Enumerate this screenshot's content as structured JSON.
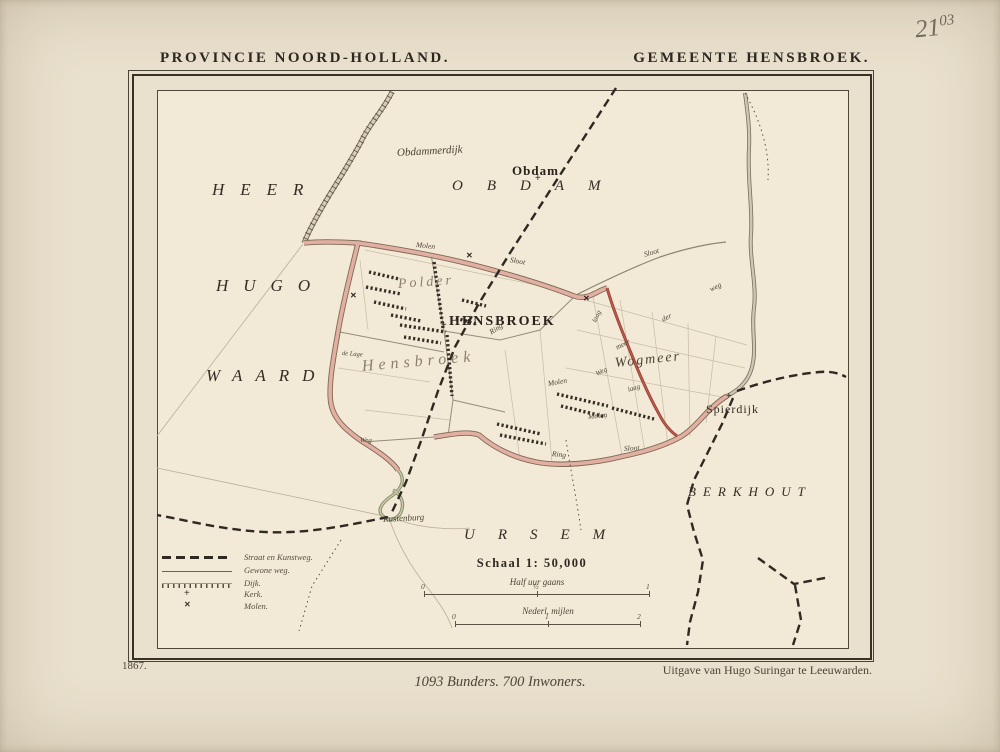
{
  "annotation": {
    "main": "21",
    "sup": "03"
  },
  "header": {
    "left": "PROVINCIE NOORD-HOLLAND.",
    "right": "GEMEENTE HENSBROEK."
  },
  "footer": {
    "year": "1867.",
    "publisher": "Uitgave van Hugo Suringar te Leeuwarden.",
    "stats": "1093 Bunders. 700 Inwoners."
  },
  "scale": {
    "schaal": "Schaal 1: 50,000",
    "bar1": {
      "label": "Half uur gaans",
      "ticks": [
        "0",
        "½",
        "1"
      ]
    },
    "bar2": {
      "label": "Nederl. mijlen",
      "ticks": [
        "0",
        "1",
        "2"
      ]
    }
  },
  "legend": {
    "items": [
      {
        "label": "Straat en Kunstweg.",
        "symbol": "road-dashed"
      },
      {
        "label": "Gewone weg.",
        "symbol": "line-thin"
      },
      {
        "label": "Dijk.",
        "symbol": "line-hatched"
      },
      {
        "label": "Kerk.",
        "symbol": "cross"
      },
      {
        "label": "Molen.",
        "symbol": "windmill"
      }
    ]
  },
  "icons": {
    "kerk": "+",
    "molen": "✕"
  },
  "colors": {
    "paper": "#e9e0cd",
    "map_paper": "#f2e9d6",
    "ink": "#2c2721",
    "road_pink": "#e2afa2",
    "road_red": "#c2564a",
    "road_gray": "#d6ccb8",
    "faded_label": "#8a7f6a"
  },
  "map": {
    "labels": [
      {
        "name": "label-obdammerdijk",
        "text": "Obdammerdijk",
        "x": 397,
        "y": 147,
        "fs": 11,
        "rot": -3,
        "cls": "script"
      },
      {
        "name": "label-obdam-town",
        "text": "Obdam",
        "x": 512,
        "y": 163,
        "fs": 13,
        "cls": "town"
      },
      {
        "name": "label-obdam-region",
        "text": "OBDAM",
        "x": 452,
        "y": 178,
        "fs": 15,
        "ls": 24,
        "cls": "region"
      },
      {
        "name": "label-heer",
        "text": "HEER",
        "x": 212,
        "y": 180,
        "fs": 17,
        "ls": 16,
        "cls": "region"
      },
      {
        "name": "label-hugo",
        "text": "HUGO",
        "x": 216,
        "y": 276,
        "fs": 17,
        "ls": 15,
        "cls": "region"
      },
      {
        "name": "label-waard",
        "text": "WAARD",
        "x": 206,
        "y": 366,
        "fs": 17,
        "ls": 13,
        "cls": "region"
      },
      {
        "name": "label-polder",
        "text": "Polder",
        "x": 398,
        "y": 277,
        "fs": 14,
        "ls": 3,
        "rot": -4,
        "cls": "scriptfaded"
      },
      {
        "name": "label-hensbroek-town",
        "text": "HENSBROEK",
        "x": 449,
        "y": 314,
        "fs": 14,
        "ls": 2,
        "cls": "town"
      },
      {
        "name": "label-hensbroek-polder",
        "text": "Hensbroek",
        "x": 362,
        "y": 358,
        "fs": 16,
        "ls": 5,
        "rot": -5,
        "cls": "scriptfaded"
      },
      {
        "name": "label-wogmeer",
        "text": "Wogmeer",
        "x": 615,
        "y": 356,
        "fs": 14,
        "ls": 2,
        "rot": -6,
        "cls": "script"
      },
      {
        "name": "label-spierdijk",
        "text": "Spierdijk",
        "x": 706,
        "y": 402,
        "fs": 12,
        "cls": "townlight"
      },
      {
        "name": "label-berkhout",
        "text": "BERKHOUT",
        "x": 688,
        "y": 484,
        "fs": 13,
        "ls": 7,
        "cls": "region"
      },
      {
        "name": "label-ursem",
        "text": "URSEM",
        "x": 464,
        "y": 527,
        "fs": 15,
        "ls": 23,
        "cls": "region"
      },
      {
        "name": "label-rustenburg",
        "text": "Rustenburg",
        "x": 383,
        "y": 514,
        "fs": 9,
        "rot": -3,
        "cls": "script"
      },
      {
        "name": "road-label-molen-1",
        "text": "Molen",
        "x": 416,
        "y": 240,
        "fs": 7.5,
        "rot": 6,
        "cls": "road"
      },
      {
        "name": "road-label-sloot-1",
        "text": "Sloot",
        "x": 510,
        "y": 255,
        "fs": 7.5,
        "rot": 10,
        "cls": "road"
      },
      {
        "name": "road-label-sloot-2",
        "text": "Sloot",
        "x": 644,
        "y": 250,
        "fs": 7.5,
        "rot": -16,
        "cls": "road"
      },
      {
        "name": "road-label-weg-1",
        "text": "weg",
        "x": 710,
        "y": 285,
        "fs": 7.5,
        "rot": -27,
        "cls": "road"
      },
      {
        "name": "road-label-der",
        "text": "der",
        "x": 662,
        "y": 315,
        "fs": 7.5,
        "rot": -27,
        "cls": "road"
      },
      {
        "name": "road-label-meer",
        "text": "meer",
        "x": 616,
        "y": 343,
        "fs": 7.5,
        "rot": -27,
        "cls": "road"
      },
      {
        "name": "road-label-laag-1",
        "text": "laag",
        "x": 594,
        "y": 318,
        "fs": 7,
        "rot": -65,
        "cls": "road"
      },
      {
        "name": "road-label-ring-1",
        "text": "Ring",
        "x": 490,
        "y": 328,
        "fs": 7.5,
        "rot": -33,
        "cls": "road"
      },
      {
        "name": "road-label-de-lage",
        "text": "de Lage",
        "x": 342,
        "y": 350,
        "fs": 6.5,
        "rot": 4,
        "cls": "road"
      },
      {
        "name": "road-label-weg-2",
        "text": "Weg",
        "x": 360,
        "y": 436,
        "fs": 7,
        "rot": 2,
        "cls": "road"
      },
      {
        "name": "road-label-molen-2",
        "text": "Molen",
        "x": 548,
        "y": 379,
        "fs": 7.5,
        "rot": -10,
        "cls": "road"
      },
      {
        "name": "road-label-weg-3",
        "text": "Weg",
        "x": 596,
        "y": 370,
        "fs": 7,
        "rot": -25,
        "cls": "road"
      },
      {
        "name": "road-label-molen-3",
        "text": "Molen",
        "x": 588,
        "y": 412,
        "fs": 7.5,
        "rot": -6,
        "cls": "road"
      },
      {
        "name": "road-label-laag-2",
        "text": "laag",
        "x": 628,
        "y": 386,
        "fs": 7,
        "rot": -18,
        "cls": "road"
      },
      {
        "name": "road-label-ring-2",
        "text": "Ring",
        "x": 552,
        "y": 449,
        "fs": 7.5,
        "rot": 6,
        "cls": "road"
      },
      {
        "name": "road-label-sloot-3",
        "text": "Sloot",
        "x": 624,
        "y": 444,
        "fs": 7.5,
        "rot": -4,
        "cls": "road"
      }
    ],
    "markers": [
      {
        "type": "kerk",
        "x": 535,
        "y": 174
      },
      {
        "type": "kerk",
        "x": 441,
        "y": 321
      },
      {
        "type": "kerk",
        "x": 726,
        "y": 392
      },
      {
        "type": "molen",
        "x": 350,
        "y": 292
      },
      {
        "type": "molen",
        "x": 466,
        "y": 252
      },
      {
        "type": "molen",
        "x": 583,
        "y": 295
      }
    ]
  }
}
